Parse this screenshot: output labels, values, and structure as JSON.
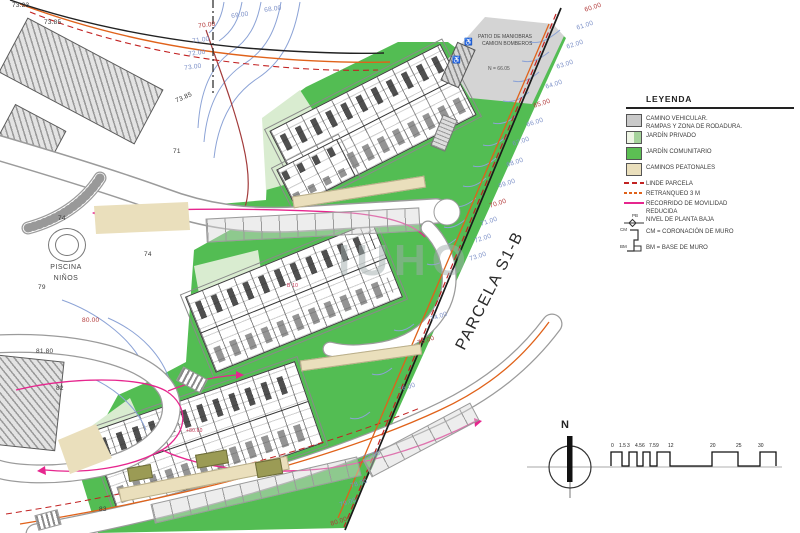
{
  "legend": {
    "title": "LEYENDA",
    "items": [
      {
        "line1": "CAMINO VEHICULAR.",
        "line2": "RAMPAS Y ZONA DE RODADURA."
      },
      {
        "line1": "JARDÍN PRIVADO"
      },
      {
        "line1": "JARDÍN COMUNITARIO"
      },
      {
        "line1": "CAMINOS PEATONALES"
      },
      {
        "line1": "LINDE PARCELA"
      },
      {
        "line1": "RETRANQUEO 3 M"
      },
      {
        "line1": "RECORRIDO DE MOVILIDAD",
        "line2": "REDUCIDA"
      },
      {
        "line1": "NIVEL DE PLANTA BAJA",
        "sym": "PB"
      },
      {
        "line1": "CM = CORONACIÓN DE MURO",
        "line2": "BM = BASE DE MURO",
        "sym_top": "CM",
        "sym_bottom": "BM"
      }
    ]
  },
  "map": {
    "parcel_label": "PARCELA S1-B",
    "pool_label_line1": "PISCINA",
    "pool_label_line2": "NIÑOS",
    "patio_label_line1": "PATIO DE MANIOBRAS",
    "patio_label_line2": "CAMION BOMBEROS",
    "patio_level": "N = 66.05",
    "watermark": "IUHO",
    "north_label": "N",
    "labels": [
      {
        "text": "60.00",
        "c": "red",
        "x": 584,
        "y": 8,
        "rot": -18
      },
      {
        "text": "61.00",
        "c": "blue",
        "x": 576,
        "y": 26,
        "rot": -18
      },
      {
        "text": "62.00",
        "c": "blue",
        "x": 566,
        "y": 45,
        "rot": -18
      },
      {
        "text": "63.00",
        "c": "blue",
        "x": 556,
        "y": 65,
        "rot": -18
      },
      {
        "text": "64.00",
        "c": "blue",
        "x": 545,
        "y": 85,
        "rot": -18
      },
      {
        "text": "65.00",
        "c": "red",
        "x": 533,
        "y": 104,
        "rot": -18
      },
      {
        "text": "66.00",
        "c": "blue",
        "x": 526,
        "y": 123,
        "rot": -18
      },
      {
        "text": "67.00",
        "c": "blue",
        "x": 512,
        "y": 142,
        "rot": -18
      },
      {
        "text": "68.00",
        "c": "blue",
        "x": 506,
        "y": 163,
        "rot": -18
      },
      {
        "text": "69.00",
        "c": "blue",
        "x": 498,
        "y": 184,
        "rot": -18
      },
      {
        "text": "70.00",
        "c": "red",
        "x": 489,
        "y": 204,
        "rot": -18
      },
      {
        "text": "71.00",
        "c": "blue",
        "x": 480,
        "y": 222,
        "rot": -18
      },
      {
        "text": "72.00",
        "c": "blue",
        "x": 474,
        "y": 239,
        "rot": -18
      },
      {
        "text": "73.00",
        "c": "blue",
        "x": 469,
        "y": 257,
        "rot": -18
      },
      {
        "text": "74.00",
        "c": "blue",
        "x": 430,
        "y": 317,
        "rot": -18
      },
      {
        "text": "75.00",
        "c": "red",
        "x": 417,
        "y": 341,
        "rot": -18
      },
      {
        "text": "76.00",
        "c": "blue",
        "x": 398,
        "y": 388,
        "rot": -18
      },
      {
        "text": "77.00",
        "c": "blue",
        "x": 363,
        "y": 456,
        "rot": -18
      },
      {
        "text": "78.00",
        "c": "blue",
        "x": 350,
        "y": 484,
        "rot": -18
      },
      {
        "text": "79.00",
        "c": "blue",
        "x": 339,
        "y": 503,
        "rot": -18
      },
      {
        "text": "80.00",
        "c": "red",
        "x": 330,
        "y": 522,
        "rot": -18
      },
      {
        "text": "68.00",
        "c": "blue",
        "x": 264,
        "y": 8,
        "rot": -8
      },
      {
        "text": "69.00",
        "c": "blue",
        "x": 231,
        "y": 14,
        "rot": -8
      },
      {
        "text": "70.00",
        "c": "red",
        "x": 198,
        "y": 24,
        "rot": -8
      },
      {
        "text": "71.00",
        "c": "blue",
        "x": 192,
        "y": 39,
        "rot": -8
      },
      {
        "text": "72.00",
        "c": "blue",
        "x": 188,
        "y": 52,
        "rot": -8
      },
      {
        "text": "73.00",
        "c": "blue",
        "x": 184,
        "y": 66,
        "rot": -8
      },
      {
        "text": "73.23",
        "c": "black",
        "x": 12,
        "y": 3
      },
      {
        "text": "73.85",
        "c": "black",
        "x": 44,
        "y": 20
      },
      {
        "text": "73.85",
        "c": "black",
        "x": 175,
        "y": 99,
        "rot": -24
      },
      {
        "text": "71",
        "c": "black",
        "x": 173,
        "y": 149
      },
      {
        "text": "74",
        "c": "black",
        "x": 58,
        "y": 216
      },
      {
        "text": "74",
        "c": "black",
        "x": 144,
        "y": 252
      },
      {
        "text": "79",
        "c": "black",
        "x": 38,
        "y": 285
      },
      {
        "text": "80.00",
        "c": "red",
        "x": 82,
        "y": 318
      },
      {
        "text": "81.80",
        "c": "black",
        "x": 36,
        "y": 349
      },
      {
        "text": "82",
        "c": "black",
        "x": 56,
        "y": 386
      },
      {
        "text": "83",
        "c": "black",
        "x": 99,
        "y": 507
      },
      {
        "text": "B 10",
        "c": "redtiny",
        "x": 287,
        "y": 284,
        "size": 5
      },
      {
        "text": "+80.60",
        "c": "redtiny",
        "x": 186,
        "y": 429,
        "size": 5
      }
    ]
  },
  "scalebar": {
    "ticks": [
      {
        "t": "0",
        "x": 611
      },
      {
        "t": "1.5",
        "x": 619
      },
      {
        "t": "3",
        "x": 627
      },
      {
        "t": "4.5",
        "x": 635
      },
      {
        "t": "6",
        "x": 642
      },
      {
        "t": "7.5",
        "x": 649
      },
      {
        "t": "9",
        "x": 656
      },
      {
        "t": "12",
        "x": 668
      },
      {
        "t": "20",
        "x": 710
      },
      {
        "t": "25",
        "x": 736
      },
      {
        "t": "30",
        "x": 758
      }
    ]
  },
  "colors": {
    "communal_garden": "#53bd53",
    "private_garden": "#d9ecd0",
    "pedestrian_path": "#eadfbc",
    "vehicular_road": "#c9c9c9",
    "linde_parcela": "#c22222",
    "retranqueo": "#e0621a",
    "movilidad_reducida": "#e6268e",
    "contour_minor": "#8ca3d6",
    "contour_major": "#a23b3b"
  }
}
